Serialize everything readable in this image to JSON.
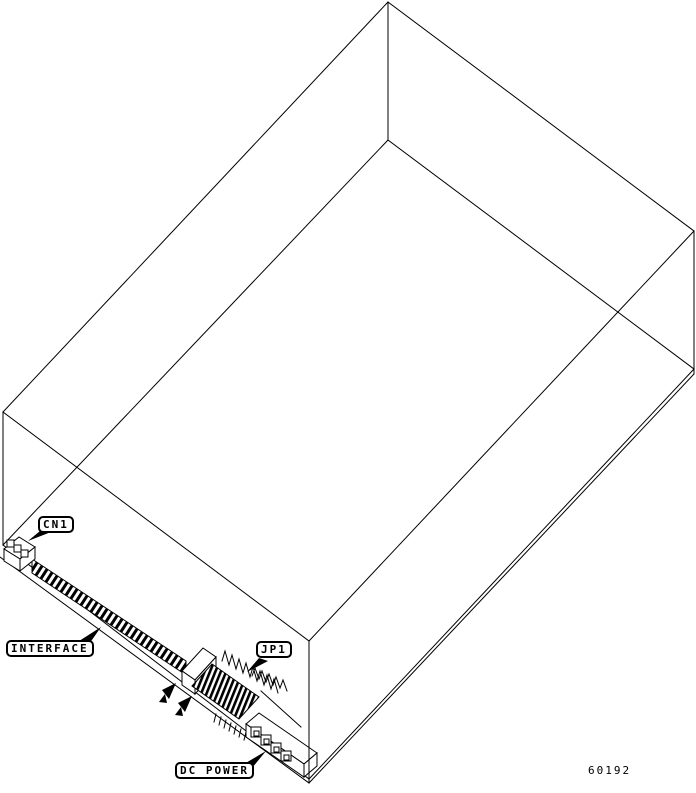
{
  "diagram": {
    "callouts": {
      "cn1": "CN1",
      "interface": "INTERFACE",
      "jp1": "JP1",
      "dc_power": "DC POWER"
    },
    "figure_number": "60192",
    "colors": {
      "line": "#000000",
      "background": "#ffffff"
    }
  }
}
